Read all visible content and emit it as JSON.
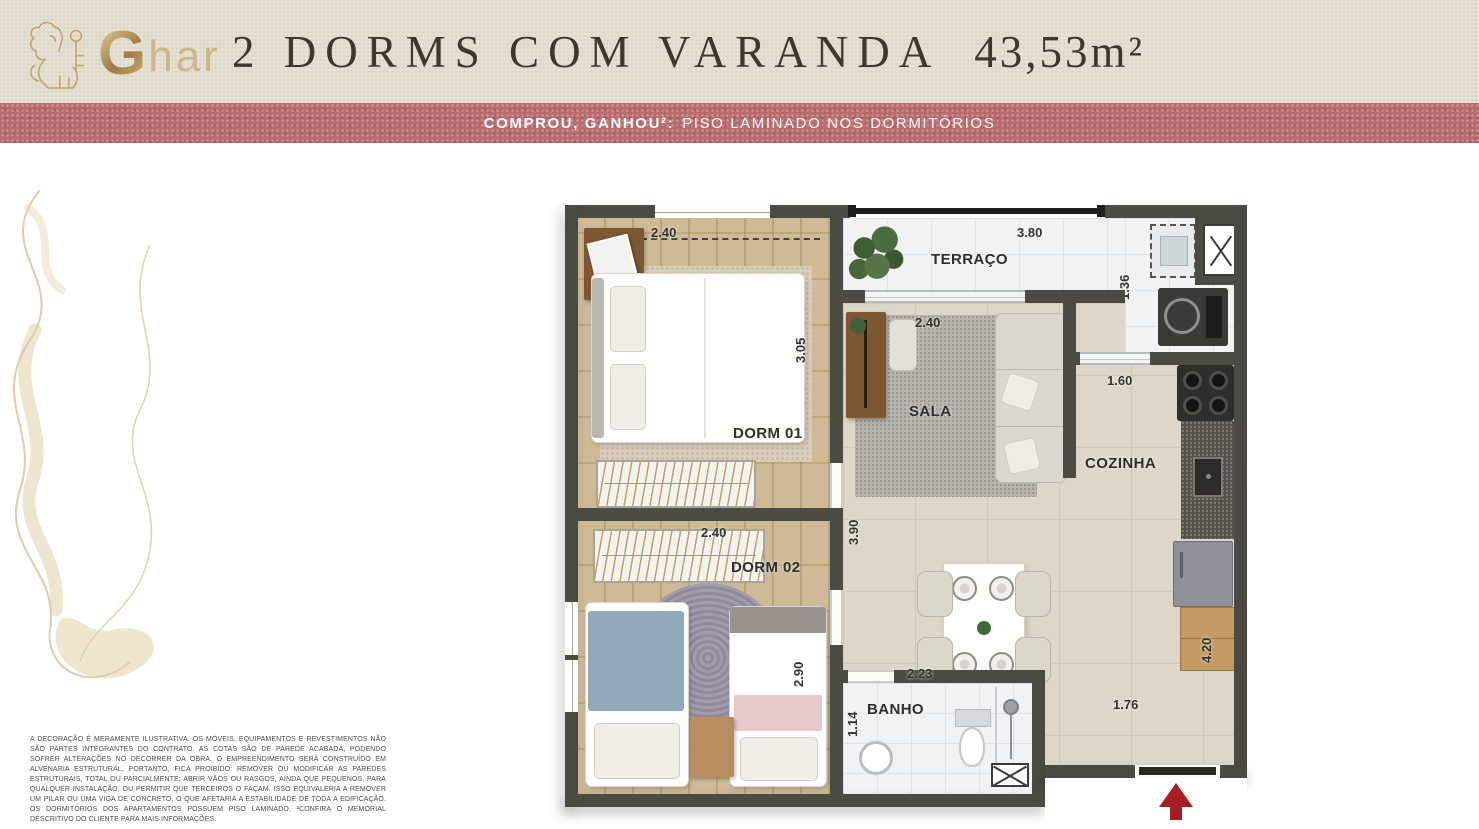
{
  "brand": {
    "g": "G",
    "suffix": "har"
  },
  "header": {
    "title": "2 DORMS COM VARANDA",
    "area": "43,53m²"
  },
  "banner": {
    "highlight": "COMPROU, GANHOU²:",
    "text": "PISO LAMINADO NOS DORMITÓRIOS"
  },
  "plan": {
    "dorm01": {
      "label": "DORM 01",
      "width": "2.40",
      "depth": "3.05"
    },
    "dorm02": {
      "label": "DORM 02",
      "width": "2.40",
      "depth": "2.90"
    },
    "terraco": {
      "label": "TERRAÇO",
      "width": "3.80"
    },
    "laundry": {
      "depth": "1.36"
    },
    "sala": {
      "label": "SALA",
      "width": "2.40"
    },
    "living": {
      "depth": "3.90"
    },
    "cozinha": {
      "label": "COZINHA",
      "pass": "1.60",
      "depth": "4.20"
    },
    "banho": {
      "label": "BANHO",
      "width": "2.23",
      "depth": "1.14"
    },
    "entry": {
      "width": "1.76"
    }
  },
  "disclaimer": "A DECORAÇÃO É MERAMENTE ILUSTRATIVA. OS MÓVEIS, EQUIPAMENTOS E REVESTIMENTOS NÃO SÃO PARTES INTEGRANTES DO CONTRATO. AS COTAS SÃO DE PAREDE ACABADA, PODENDO SOFRER ALTERAÇÕES NO DECORRER DA OBRA. O EMPREENDIMENTO SERÁ CONSTRUÍDO EM ALVENARIA ESTRUTURAL, PORTANTO, FICA PROIBIDO: REMOVER OU MODIFICAR AS PAREDES ESTRUTURAIS, TOTAL OU PARCIALMENTE; ABRIR VÃOS OU RASGOS, AINDA QUE PEQUENOS, PARA QUALQUER INSTALAÇÃO, OU PERMITIR QUE TERCEIROS O FAÇAM. ISSO EQUIVALERIA A REMOVER UM PILAR OU UMA VIGA DE CONCRETO, O QUE AFETARIA A ESTABILIDADE DE TODA A EDIFICAÇÃO. OS DORMITÓRIOS DOS APARTAMENTOS POSSUEM PISO LAMINADO. ²CONFIRA O MEMORIAL DESCRITIVO DO CLIENTE PARA MAIS INFORMAÇÕES.",
  "colors": {
    "gold": "#c2a265",
    "banner_rose": "#b76b6e",
    "header_beige": "#dfdacc",
    "wall": "#4b4a43",
    "wood_floor": "#cab28a",
    "tile_white": "#f0f2f3",
    "tile_beige": "#ded7c9",
    "arrow_red": "#a81d22"
  }
}
